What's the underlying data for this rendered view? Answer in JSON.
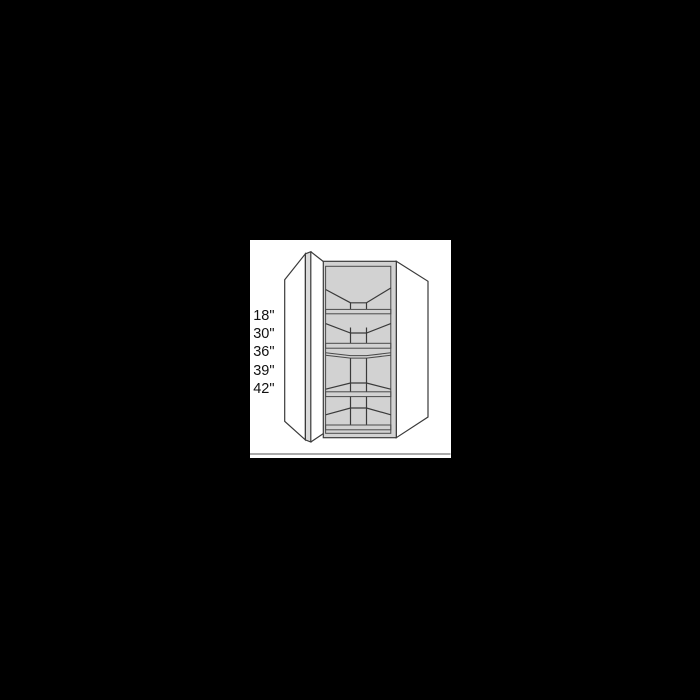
{
  "page": {
    "background": "#000000"
  },
  "artwork": {
    "panel_background": "#ffffff",
    "size_labels": [
      "18\"",
      "30\"",
      "36\"",
      "39\"",
      "42\""
    ],
    "colors": {
      "line": "#3a3a3a",
      "panel_fill": "#ffffff",
      "frame_fill": "#d2d2d2",
      "shelf_fill": "#c6c6c6",
      "door_edge_fill": "#dadada",
      "baseline_rule": "#8e8e8e",
      "label_text": "#111111"
    }
  }
}
